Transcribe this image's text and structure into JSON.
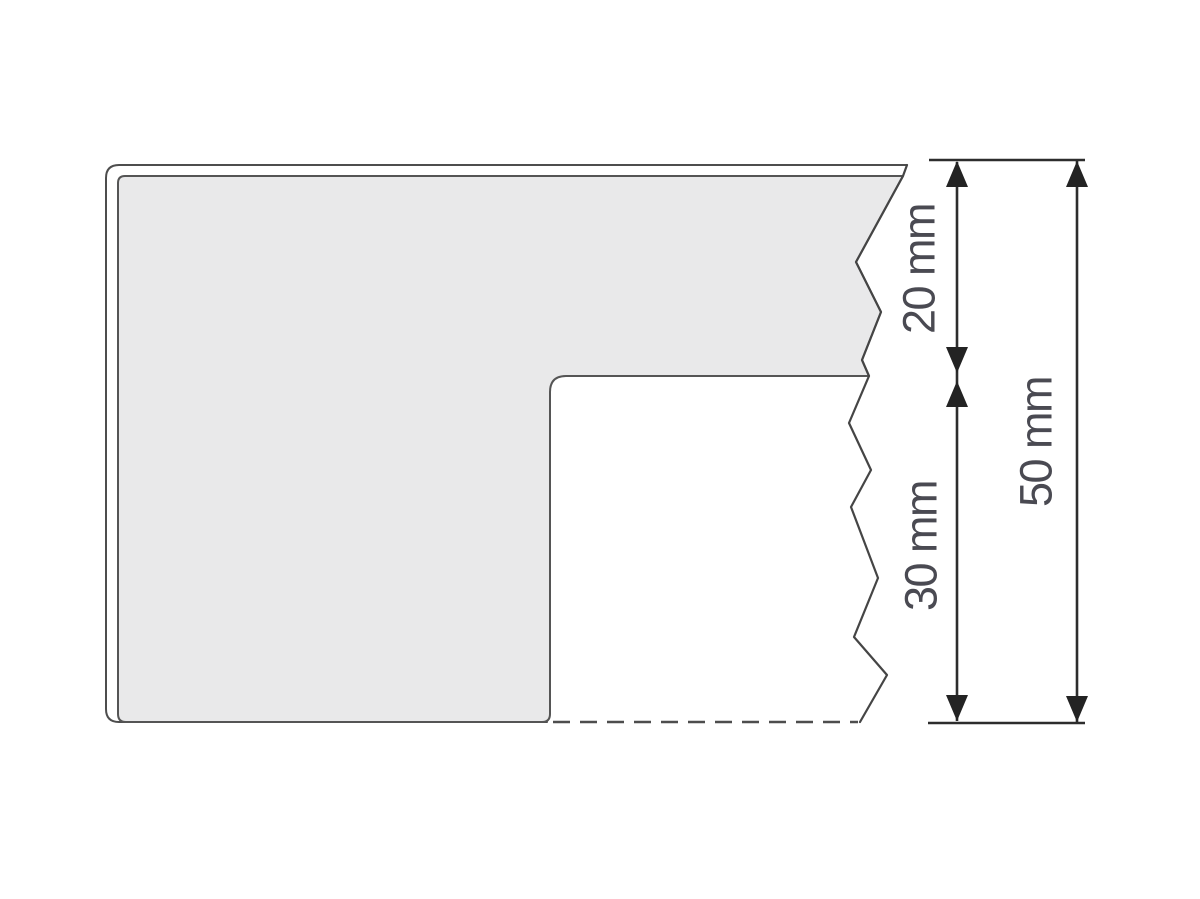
{
  "diagram": {
    "kind": "technical-cross-section",
    "unit": "mm",
    "dimensions": [
      {
        "id": "upper-band-height",
        "label": "20 mm",
        "value": 20
      },
      {
        "id": "lower-cutout-height",
        "label": "30 mm",
        "value": 30
      },
      {
        "id": "overall-height",
        "label": "50 mm",
        "value": 50
      }
    ],
    "colors": {
      "background": "#ffffff",
      "panel_fill": "#e9e9ea",
      "outline": "#4d4d4d",
      "dimension_line": "#2d2d2d",
      "arrowhead": "#232323",
      "label_text": "#4a4a52"
    }
  }
}
